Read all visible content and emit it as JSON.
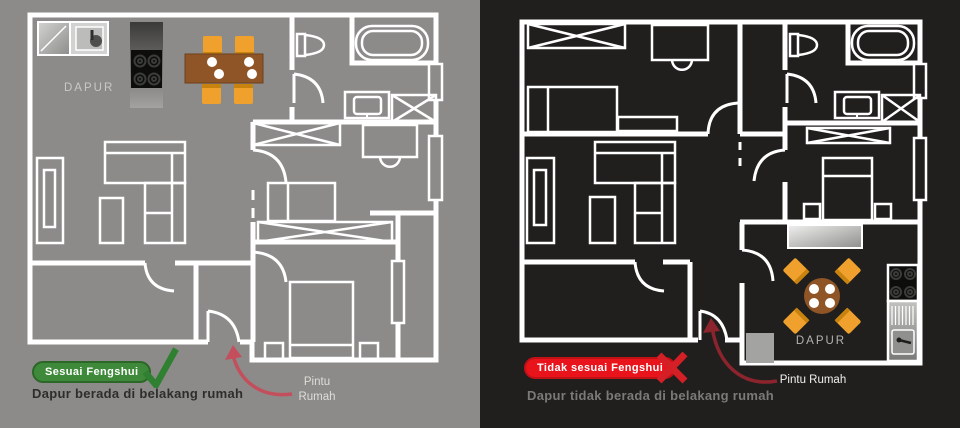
{
  "panels": {
    "left": {
      "background": "#8c8b89",
      "wall_color": "#ffffff",
      "room_label": "DAPUR",
      "door_label_line1": "Pintu",
      "door_label_line2": "Rumah",
      "badge": {
        "label": "Sesuai Fengshui",
        "bg": "#3e8a3a",
        "border": "#2c6628",
        "text_color": "#ffffff"
      },
      "verdict": {
        "icon": "check-icon",
        "color": "#2f8030"
      },
      "caption": {
        "text": "Dapur berada di belakang rumah",
        "color": "#2e2d2b"
      },
      "arrow_color": "#c44f5c"
    },
    "right": {
      "background": "#201f1d",
      "wall_color": "#ffffff",
      "room_label": "DAPUR",
      "door_label": "Pintu Rumah",
      "badge": {
        "label": "Tidak sesuai Fengshui",
        "bg": "#e9141b",
        "border": "#c11016",
        "text_color": "#ffffff"
      },
      "verdict": {
        "icon": "x-icon",
        "color": "#d51f26"
      },
      "caption": {
        "text": "Dapur tidak berada di belakang rumah",
        "color": "#7b7a78"
      },
      "arrow_color": "#8c242e"
    }
  },
  "furniture_colors": {
    "table_brown": "#8f5527",
    "chair_orange": "#f0a12d",
    "chair_stripe": "#c8830f",
    "plate_white": "#ffffff",
    "stove_black": "#0d0d0c"
  }
}
